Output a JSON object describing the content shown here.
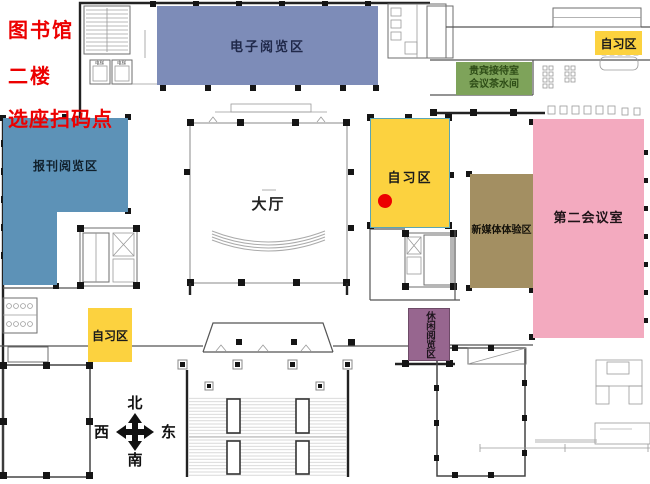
{
  "legend": {
    "title": "图书馆",
    "floor": "二楼",
    "marker_label": "选座扫码点",
    "marker_color": "#ec0000"
  },
  "zones": {
    "electronic_reading": {
      "label": "电子阅览区",
      "color": "#7d8cb8"
    },
    "newspaper_reading": {
      "label": "报刊阅览区",
      "color": "#5d92b7"
    },
    "hall": {
      "label": "大厅",
      "color": "#ffffff"
    },
    "study_center": {
      "label": "自习区",
      "color": "#fcd23f"
    },
    "study_top_right": {
      "label": "自习区",
      "color": "#fcd23f"
    },
    "study_bottom_left": {
      "label": "自习区",
      "color": "#fcd23f"
    },
    "vip_reception": {
      "line1": "贵宾接待室",
      "line2": "会议茶水间",
      "color": "#7ea35a"
    },
    "new_media": {
      "label": "新媒体体验区",
      "color": "#a38f62"
    },
    "second_meeting": {
      "label": "第二会议室",
      "color": "#f3aabf"
    },
    "leisure_reading": {
      "label": "休闲阅览区",
      "color": "#97668f"
    }
  },
  "plan": {
    "elevator_label": "电梯"
  },
  "compass": {
    "north": "北",
    "south": "南",
    "west": "西",
    "east": "东"
  }
}
